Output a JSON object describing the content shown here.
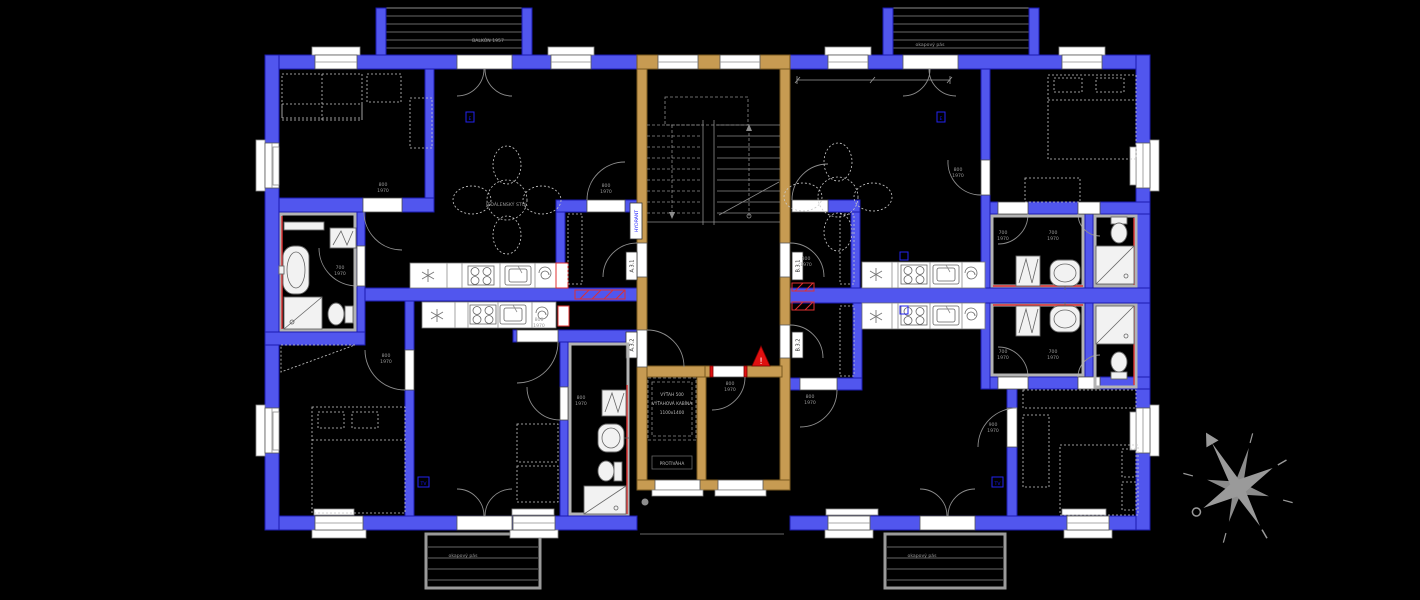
{
  "balconies": {
    "top_left": "BALKÓN 1957",
    "top_right": "okapový pás",
    "bottom_left": "okapový pás",
    "bottom_right": "okapový pás"
  },
  "stairwell": {
    "hydrant_label": "HYDRANT",
    "warning_mark": "!"
  },
  "elevator": {
    "line1": "VÝŤAH 500",
    "line2": "VÝŤAHOVÁ KABÍNA",
    "line3": "1100x1400",
    "counterweight": "PROTIVÁHA"
  },
  "apartments": {
    "a31": "A.3.1",
    "a32": "A.3.2",
    "b31": "B.3.1",
    "b32": "B.3.2"
  },
  "door_sizes": {
    "w700": "700",
    "w800": "800",
    "w900": "900",
    "h": "1970"
  },
  "rooms": {
    "dining_table": "JEDÁLENSKÝ STÔL"
  },
  "markers": {
    "electrical": "E",
    "tv": "TV"
  },
  "colors": {
    "wall": "#5156ee",
    "stair_wall": "#c79b52",
    "fixture": "#9a9a9a",
    "warning": "#e01010",
    "hydrant_text": "#1414ff",
    "waterproof": "#e03030"
  },
  "icons": {
    "fridge": "asterisk-star",
    "stove": "four-burners",
    "sink": "basin",
    "extractor": "spiral",
    "warning_triangle": "exclamation-triangle",
    "compass": "eight-point-star"
  }
}
